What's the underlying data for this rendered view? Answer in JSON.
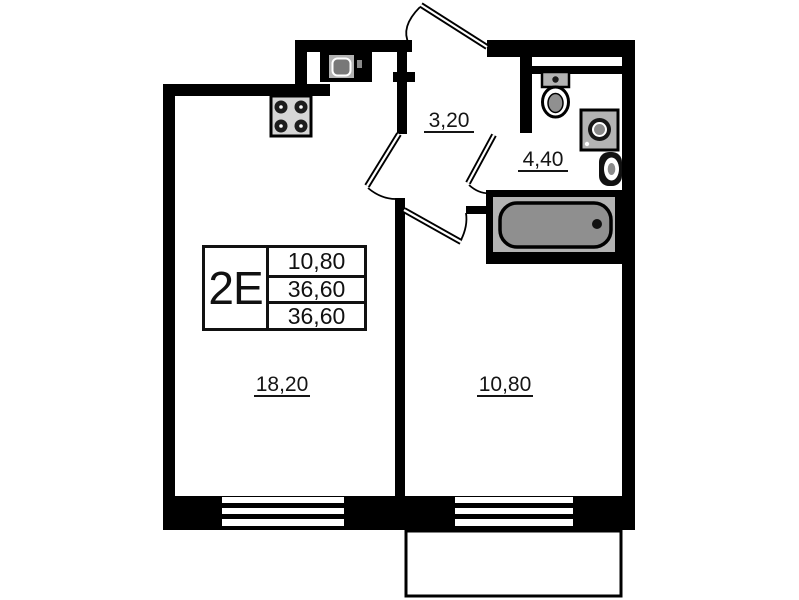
{
  "plan": {
    "unit": {
      "type_label": "2E",
      "areas": [
        "10,80",
        "36,60",
        "36,60"
      ]
    },
    "rooms": {
      "living_room": {
        "area": "18,20"
      },
      "bedroom": {
        "area": "10,80"
      },
      "hallway": {
        "area": "3,20"
      },
      "bathroom": {
        "area": "4,40"
      }
    },
    "fixtures": [
      "stove-icon",
      "kitchen-sink-icon",
      "toilet-icon",
      "washing-machine-icon",
      "washbasin-icon",
      "bathtub-icon"
    ],
    "colors": {
      "wall": "#000000",
      "background": "#ffffff",
      "fixture_fill": "#b3b3b3",
      "tub_fill": "#8f8f8f"
    }
  }
}
